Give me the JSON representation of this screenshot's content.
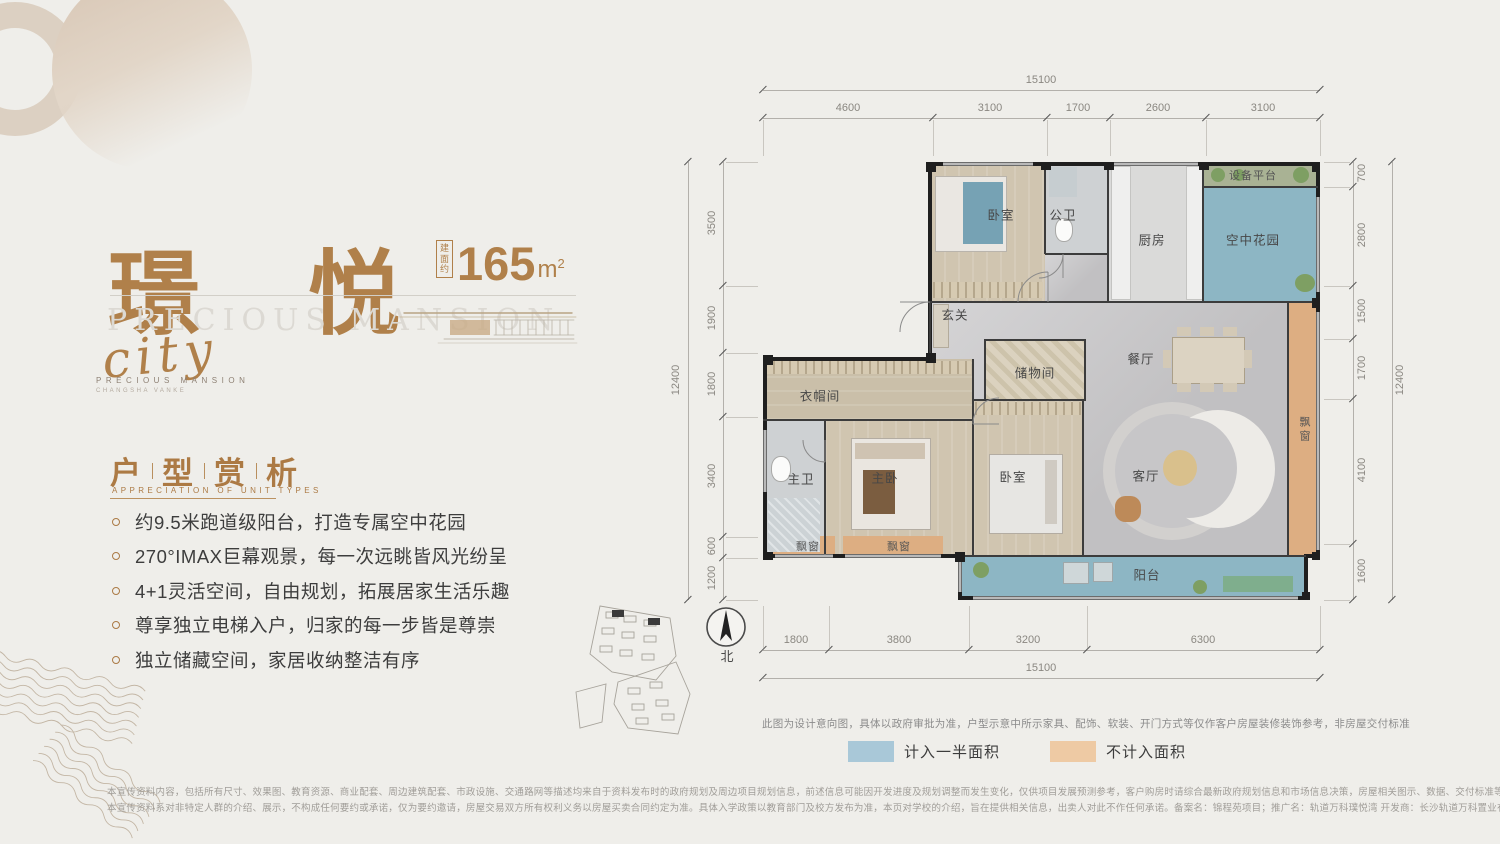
{
  "brand": {
    "title": "璟 悦",
    "area_box_chars": [
      "建",
      "面",
      "约"
    ],
    "area_value": "165",
    "area_unit": "m",
    "area_sup": "2",
    "ghost_title": "PRECIOUS MANSION",
    "script_word": "city",
    "sub_brand": "PRECIOUS MANSION",
    "sub_brand2": "CHANGSHA VANKE"
  },
  "section": {
    "title_chars": [
      "户",
      "型",
      "赏",
      "析"
    ],
    "subtitle": "APPRECIATION OF UNIT TYPES",
    "bullets": [
      "约9.5米跑道级阳台，打造专属空中花园",
      "270°IMAX巨幕观景，每一次远眺皆风光纷呈",
      "4+1灵活空间，自由规划，拓展居家生活乐趣",
      "尊享独立电梯入户，归家的每一步皆是尊崇",
      "独立储藏空间，家居收纳整洁有序"
    ]
  },
  "plan": {
    "rooms": {
      "bedroom": "卧室",
      "public_bath": "公卫",
      "kitchen": "厨房",
      "sky_garden": "空中花园",
      "equipment": "设备平台",
      "foyer": "玄关",
      "storage": "储物间",
      "dining": "餐厅",
      "cloakroom": "衣帽间",
      "master_bath": "主卫",
      "master_bedroom": "主卧",
      "living": "客厅",
      "balcony": "阳台",
      "bay_window": "飘窗"
    },
    "dims": {
      "top_total": "15100",
      "top": [
        "4600",
        "3100",
        "1700",
        "2600",
        "3100"
      ],
      "left_total": "12400",
      "left": [
        "3500",
        "1900",
        "1800",
        "3400",
        "600",
        "1200"
      ],
      "right_total": "12400",
      "right": [
        "700",
        "2800",
        "1500",
        "1700",
        "4100",
        "1600"
      ],
      "bottom": [
        "1800",
        "3800",
        "3200",
        "6300"
      ],
      "bottom_total": "15100"
    },
    "compass_label": "北",
    "disclaimer": "此图为设计意向图，具体以政府审批为准，户型示意中所示家具、配饰、软装、开门方式等仅作客户房屋装修装饰参考，非房屋交付标准",
    "legend": [
      {
        "color": "#a9c8d8",
        "label": "计入一半面积"
      },
      {
        "color": "#eecaa4",
        "label": "不计入面积"
      }
    ],
    "colors": {
      "half_area_blue": "#8db6c4",
      "excluded_orange": "#ddae82",
      "accent_bronze": "#b0804a"
    }
  },
  "footer": {
    "line1": "本宣传资料内容，包括所有尺寸、效果图、教育资源、商业配套、周边建筑配套、市政设施、交通路网等描述均来自于资料发布时的政府规划及周边项目规划信息，前述信息可能因开发进度及规划调整而发生变化，仅供项目发展预测参考，客户购房时请综合最新政府规划信息和市场信息决策，房屋相关图示、数据、交付标准等信息可能因期数、栋数、楼层、朝向的不同而存在差异",
    "line2": "本宣传资料系对非特定人群的介绍、展示，不构成任何要约或承诺，仅为要约邀请，房屋交易双方所有权利义务以房屋买卖合同约定为准。具体入学政策以教育部门及校方发布为准，本页对学校的介绍，旨在提供相关信息，出卖人对此不作任何承诺。备案名：锦程苑项目；推广名：轨道万科璞悦湾 开发商：长沙轨道万科置业有限公司 制作时间：2023年4月"
  }
}
